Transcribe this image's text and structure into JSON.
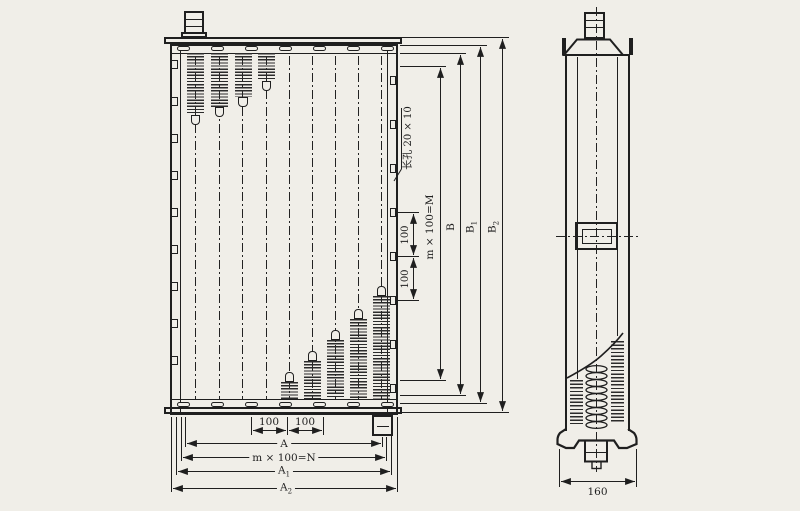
{
  "labels": {
    "slot_callout": "长孔 20 × 10",
    "col_module": "m × 100=M",
    "b": "B",
    "b1": {
      "base": "B",
      "sub": "1"
    },
    "b2": {
      "base": "B",
      "sub": "2"
    },
    "pitch_right_1": "100",
    "pitch_right_2": "100",
    "pitch_bottom_1": "100",
    "pitch_bottom_2": "100",
    "a": "A",
    "row_module": "m × 100=N",
    "a1": {
      "base": "A",
      "sub": "1"
    },
    "a2": {
      "base": "A",
      "sub": "2"
    },
    "depth": "160"
  },
  "colors": {
    "paper": "#f0eee8",
    "ink": "#1f1f1f"
  }
}
